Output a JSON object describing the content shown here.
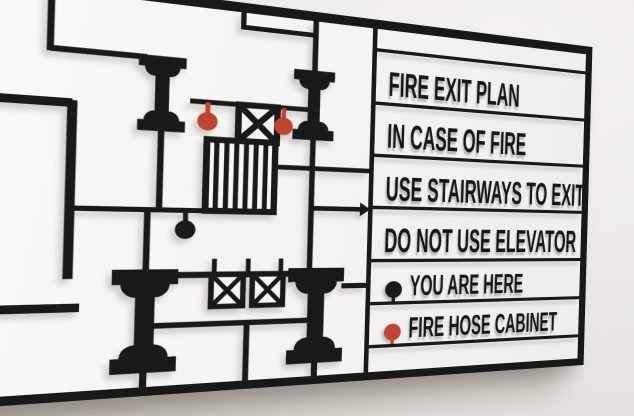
{
  "sign": {
    "panel": {
      "messages": [
        "FIRE EXIT PLAN",
        "IN CASE OF FIRE",
        "USE STAIRWAYS TO EXIT",
        "DO NOT USE ELEVATOR"
      ],
      "legend": [
        {
          "label": "YOU ARE HERE",
          "icon": "location-pin-icon",
          "pin_color": "#1a1a1a"
        },
        {
          "label": "FIRE HOSE CABINET",
          "icon": "location-pin-icon",
          "pin_color": "#c14432"
        }
      ]
    },
    "plan": {
      "symbols": [
        {
          "name": "elevator-icon",
          "count": 3
        },
        {
          "name": "stairs-icon",
          "count": 1
        },
        {
          "name": "column-icon",
          "count": 4
        },
        {
          "name": "fire-hose-pin-icon",
          "count": 2,
          "color": "#c14432"
        },
        {
          "name": "you-are-here-pin-icon",
          "count": 1,
          "color": "#1a1a1a"
        },
        {
          "name": "exit-direction-arrow-icon",
          "count": 1
        }
      ]
    },
    "colors": {
      "sign_black": "#191919",
      "pin_red": "#c14432",
      "wall": "#e9e6e2",
      "panel_bg": "#f7f5f2"
    }
  }
}
